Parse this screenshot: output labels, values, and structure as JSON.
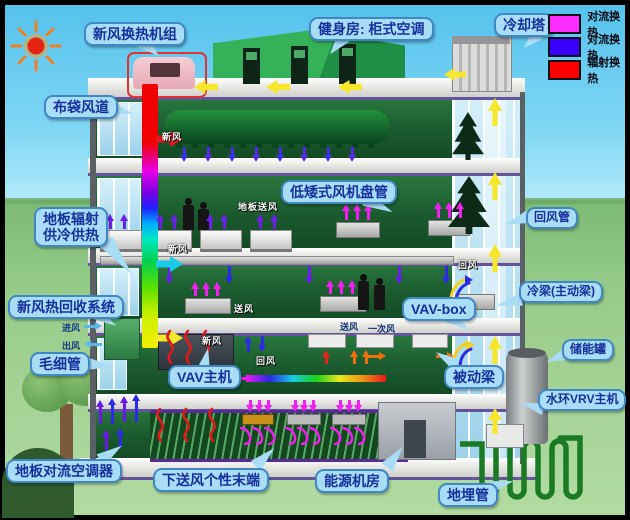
{
  "legend": {
    "items": [
      {
        "name": "convection-heat-magenta",
        "label": "对流换热",
        "color": "#ff2bff"
      },
      {
        "name": "convection-heat-blue",
        "label": "对流换热",
        "color": "#3a00ff"
      },
      {
        "name": "radiation-heat-red",
        "label": "辐射换热",
        "color": "#ff0000"
      }
    ]
  },
  "callouts": {
    "fresh_air_ahu": "新风换热机组",
    "gym_ac": "健身房: 柜式空调",
    "cooling_tower": "冷却塔",
    "bag_duct": "布袋风道",
    "floor_radiant_1": "地板辐射",
    "floor_radiant_2": "供冷供热",
    "heat_recovery": "新风热回收系统",
    "capillary": "毛细管",
    "floor_convection_ac": "地板对流空调器",
    "underfloor_terminal": "下送风个性末端",
    "energy_room": "能源机房",
    "ground_pipe": "地埋管",
    "vav_host": "VAV主机",
    "vav_box": "VAV-box",
    "passive_beam": "被动梁",
    "low_fan_coil": "低矮式风机盘管",
    "return_duct": "回风管",
    "active_beam": "冷梁(主动梁)",
    "storage_tank": "储能罐",
    "water_vrv": "水环VRV主机"
  },
  "flow": {
    "fresh_air": "新风",
    "return_air": "回风",
    "supply_air": "送风",
    "floor_supply": "地板送风",
    "primary_air": "一次风",
    "inlet": "进风",
    "outlet": "出风"
  },
  "colors": {
    "bubble_bg": "#a9ddf5",
    "bubble_border": "#3f88c5",
    "bubble_text": "#16309c",
    "sky": "#7fd6f4",
    "grass": "#97cc8b",
    "rainbow_duct": [
      "#f00000",
      "#e800e8",
      "#2020ff",
      "#00b0ff",
      "#00d050",
      "#f0f000"
    ],
    "yellow_arrow": "#f6e72a",
    "magenta_arrow": "#f21ef2",
    "purple_arrow": "#6a20e8",
    "red_radiant": "#e01818"
  }
}
